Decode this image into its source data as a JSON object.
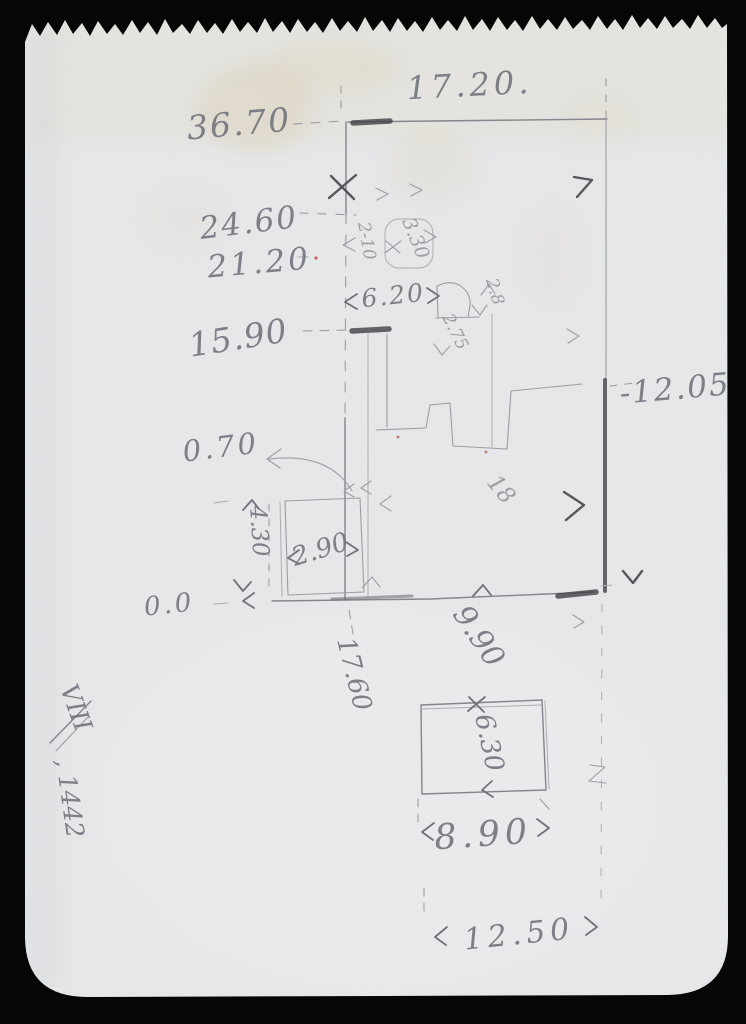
{
  "scene": {
    "description": "Pencil sketch on torn notebook page: building elevation with height levels and dimensions",
    "background_color": "#060606",
    "paper_color": "#e7e8ea",
    "pencil_color": "#83868e",
    "pencil_dark_color": "#3f4147",
    "stain_color": "#d7c49c"
  },
  "labels": {
    "width_top": "17.20.",
    "level_36_70": "36.70",
    "level_24_60": "24.60",
    "level_21_20": "21.20",
    "level_15_90": "15.90",
    "level_0_70": "0.70",
    "level_0_0": "0.0",
    "level_right": "-12.05",
    "dim_6_20": "6.20",
    "dim_3_30": "3.30",
    "dim_2_10": "2-10",
    "dim_2_8": "2.8",
    "dim_2_75": "2.75",
    "dim_2_90": "2.90",
    "dim_4_30": "4.30",
    "dim_17_60": "17.60",
    "dim_9_90": "9.90",
    "dim_18": "18",
    "dim_6_30": "6.30",
    "dim_8_90": "8.90",
    "dim_12_50": "12.50",
    "plate_roman": "VIII",
    "plate_year": ", 1442"
  }
}
